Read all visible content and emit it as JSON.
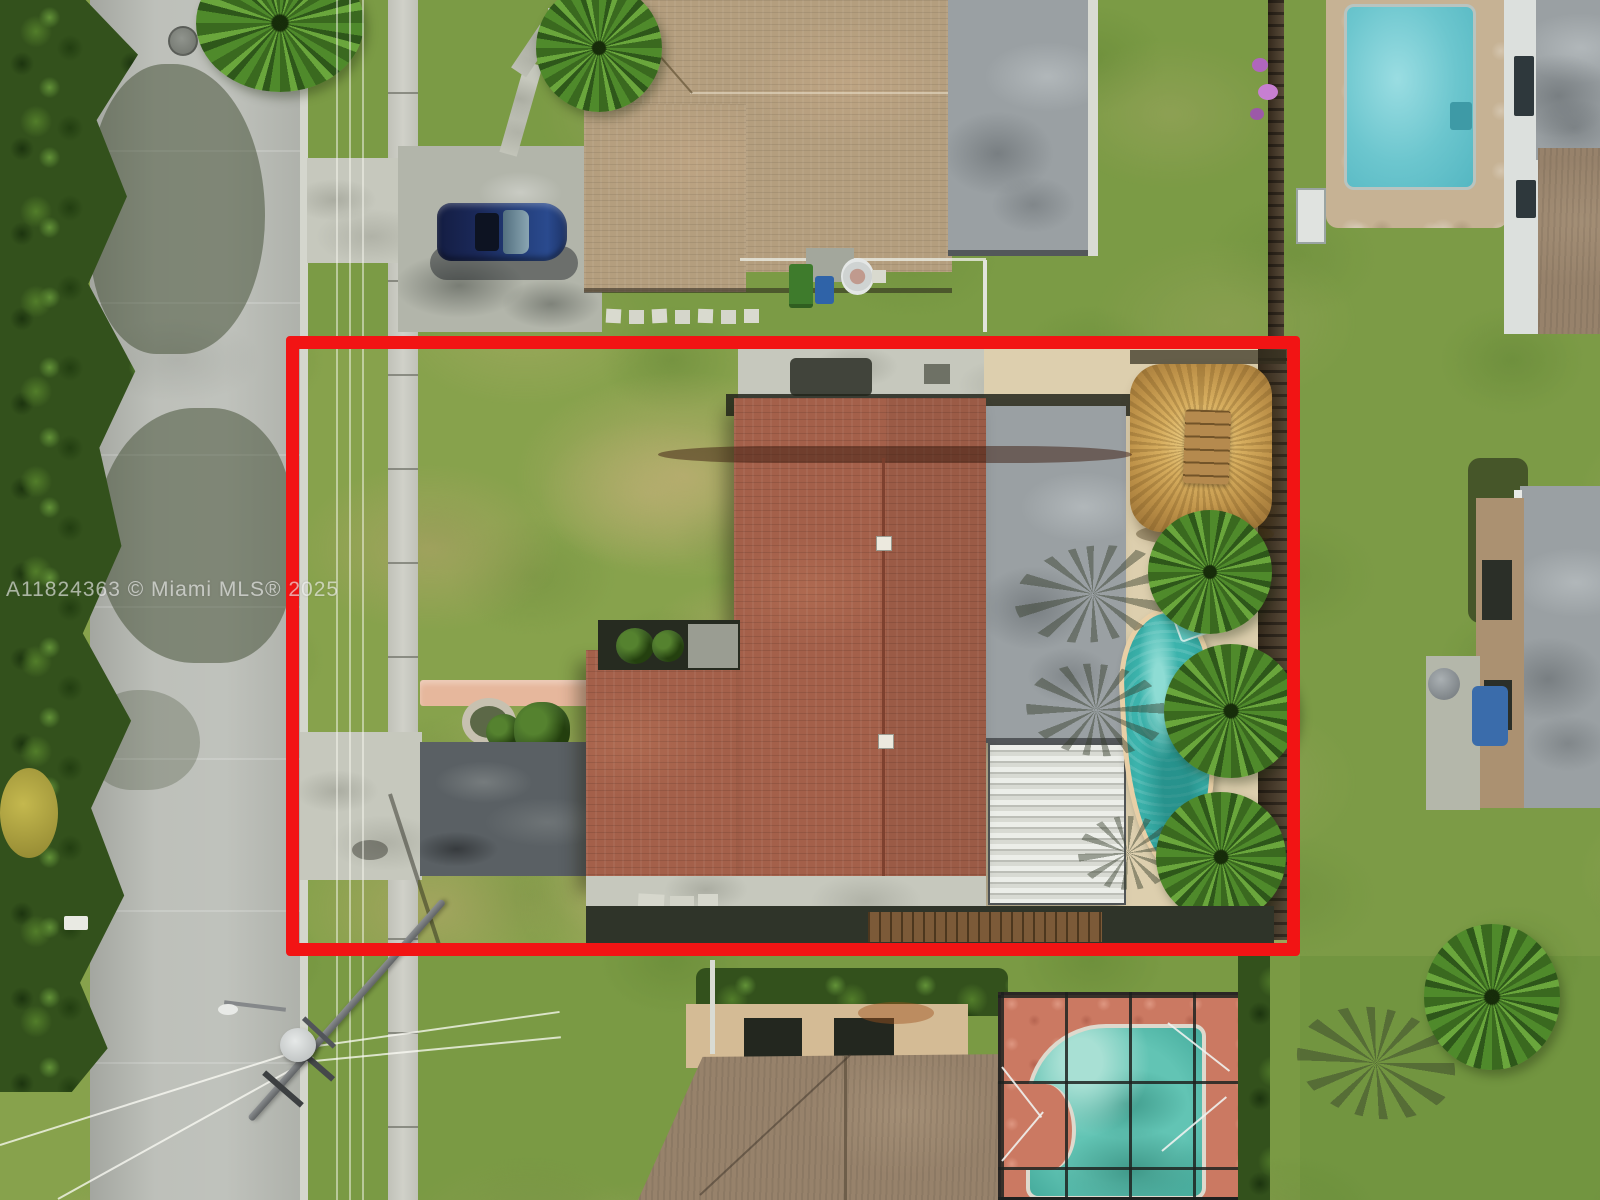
{
  "scene": {
    "type": "aerial-drone-photo",
    "subject": "Single-family home lot outlined in red in a Miami-area residential neighborhood",
    "watermark": {
      "text": "A11824363 © Miami MLS® 2025",
      "listing_id": "A11824363",
      "source": "Miami MLS",
      "year": "2025"
    },
    "boundary": {
      "shape": "rectangle",
      "color": "#f21414",
      "stroke_px": 13,
      "description": "Red outline marking the subject property parcel"
    },
    "palette": {
      "grass": "#87a24c",
      "worn_grass_tan": "#b9a472",
      "street_asphalt": "#b6b9b2",
      "sidewalk": "#cccdc4",
      "terracotta_roof": "#a4604a",
      "tan_roof": "#b49e7e",
      "flat_roof_gray": "#9aa0a3",
      "pool_teal": "#3cb3ac",
      "south_pool_green": "#62c4b4",
      "deck_cream": "#ddcfae",
      "enclosure_deck_salmon": "#cb7962",
      "tiki_straw": "#d2a95e",
      "car_navy_blue": "#1c2f66",
      "red_outline": "#f21414"
    },
    "features": [
      "subject lot with patchy grass outlined in red",
      "L-shaped house with terracotta shingle roof and two roof vents",
      "gray flat-roof addition and white corrugated patio cover",
      "thatched tiki hut with wooden ridge cap",
      "kidney-shaped teal swimming pool with diving board",
      "row of palm trees along east fence",
      "salmon front walkway, round planter and dark asphalt parking pad",
      "street, curb and sidewalk on the west side",
      "north neighbor: tan-roof house, concrete driveway with navy blue car, trash bins, round tub",
      "northeast neighbor: rectangular pool on stone deck, two-story house",
      "east neighbor: flat-roof house with dome vent and blue tarp",
      "south neighbor: gabled-roof house with screened-in green pool on salmon deck",
      "utility pole with transformer, street light and overhead power lines",
      "dense tree canopy along left edge with shadows cast on street"
    ]
  }
}
